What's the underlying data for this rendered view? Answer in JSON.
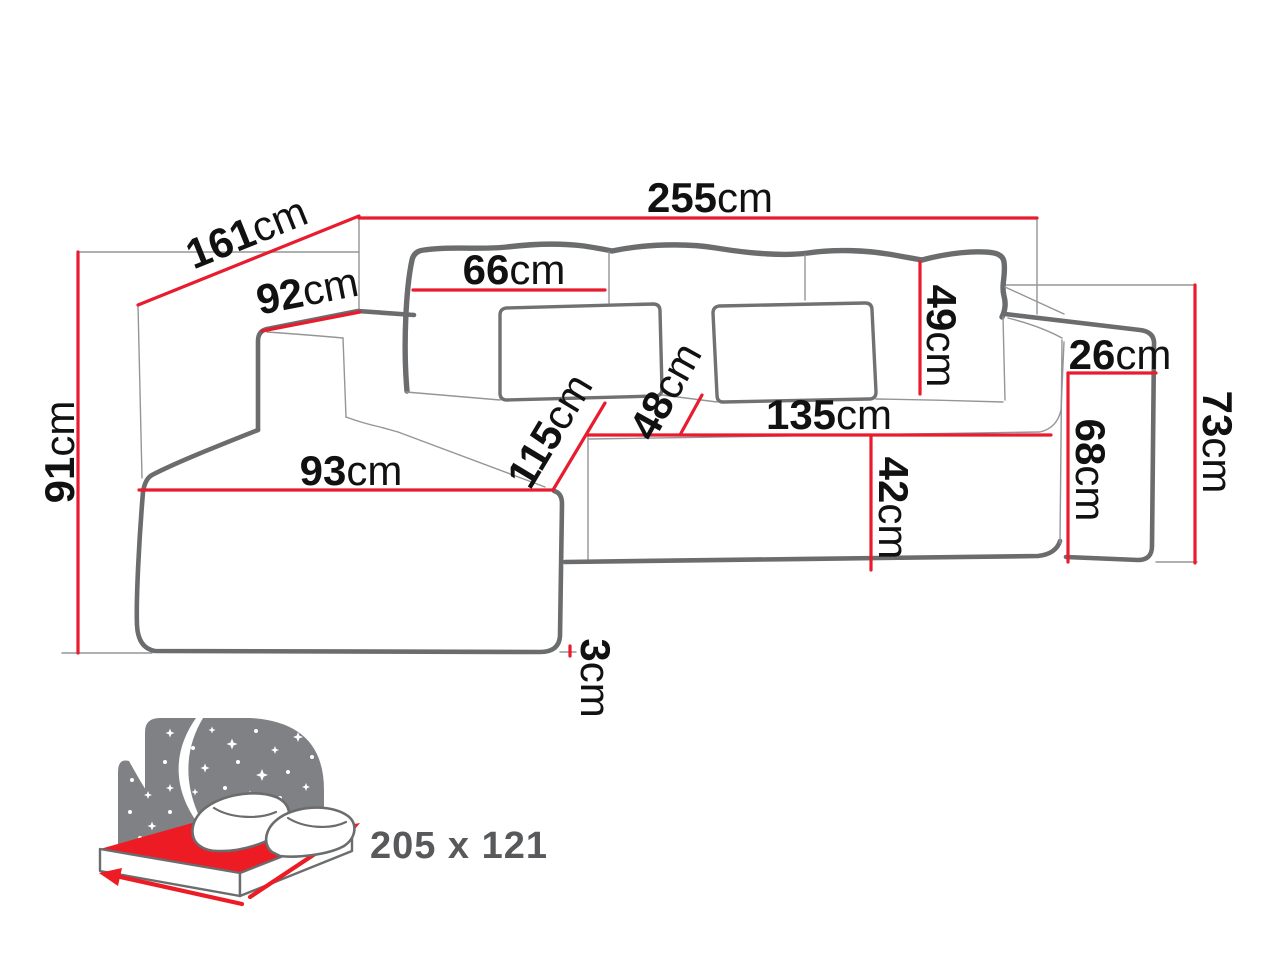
{
  "diagram": {
    "type": "corner-sofa-dimension-diagram",
    "unit": "cm",
    "dims": {
      "total_width": {
        "value": "255",
        "unit": "cm"
      },
      "depth_diagonal": {
        "value": "161",
        "unit": "cm"
      },
      "left_arm_top": {
        "value": "92",
        "unit": "cm"
      },
      "height_left": {
        "value": "91",
        "unit": "cm"
      },
      "back_cushion_width": {
        "value": "66",
        "unit": "cm"
      },
      "back_cushion_height": {
        "value": "49",
        "unit": "cm"
      },
      "right_arm_width": {
        "value": "26",
        "unit": "cm"
      },
      "height_right": {
        "value": "73",
        "unit": "cm"
      },
      "right_arm_height": {
        "value": "68",
        "unit": "cm"
      },
      "seat_width": {
        "value": "135",
        "unit": "cm"
      },
      "seat_front_height": {
        "value": "42",
        "unit": "cm"
      },
      "seat_depth_top": {
        "value": "48",
        "unit": "cm"
      },
      "chaise_length": {
        "value": "115",
        "unit": "cm"
      },
      "chaise_width": {
        "value": "93",
        "unit": "cm"
      },
      "leg_height": {
        "value": "3",
        "unit": "cm"
      }
    },
    "sleeping_function": {
      "dimensions_label": "205 x 121"
    },
    "colors": {
      "dimension_line_red": "#e81c2e",
      "sofa_outline_gray": "#6a6c6e",
      "guide_line_gray": "#939598",
      "label_text": "#111111",
      "icon_panel_gray": "#7f8184",
      "sleeping_label_gray": "#58595b",
      "icon_accent_red": "#ed1c24"
    }
  }
}
